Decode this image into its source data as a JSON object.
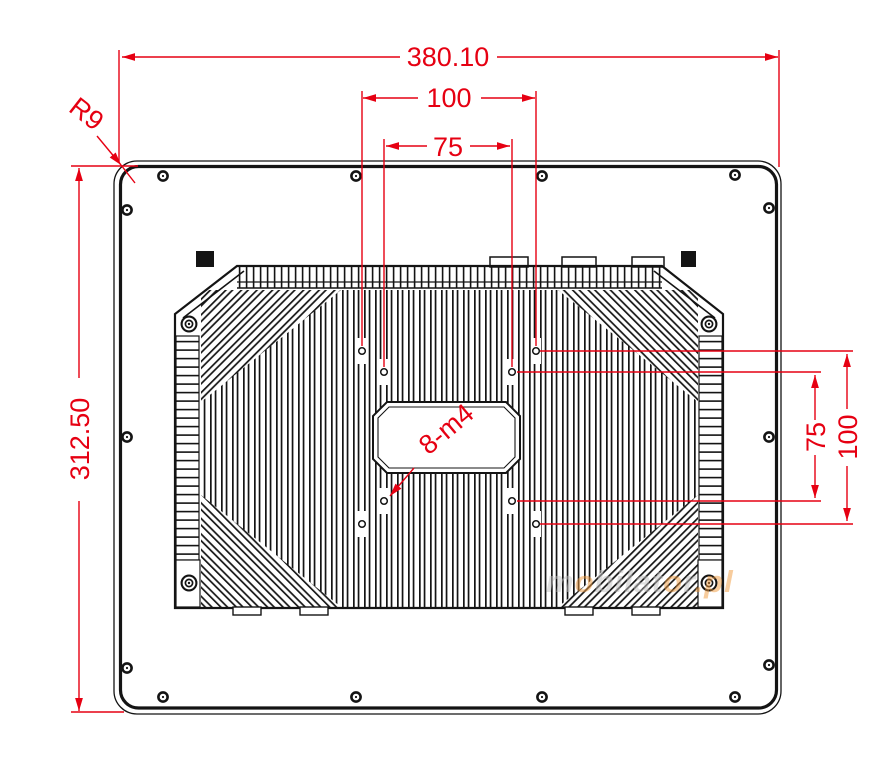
{
  "drawing": {
    "kind": "technical-dimension-drawing",
    "subject": "panel-pc-rear-view-with-heatsink-and-vesa-mount"
  },
  "dimensions": {
    "overall_width": "380.10",
    "overall_height": "312.50",
    "vesa_width_outer": "100",
    "vesa_width_inner": "75",
    "vesa_height_inner": "75",
    "vesa_height_outer": "100",
    "corner_radius": "R9",
    "hole_callout": "8-m4"
  },
  "watermark": {
    "seg1": "m",
    "seg2": "o",
    "seg3": "bilat",
    "seg4": "o",
    "seg5": "r",
    "seg6": ".pl"
  },
  "colors": {
    "dimension_red": "#e60012",
    "line_black": "#141414",
    "watermark_gray": "#c1c0c0",
    "watermark_orange": "#f09a3e"
  }
}
